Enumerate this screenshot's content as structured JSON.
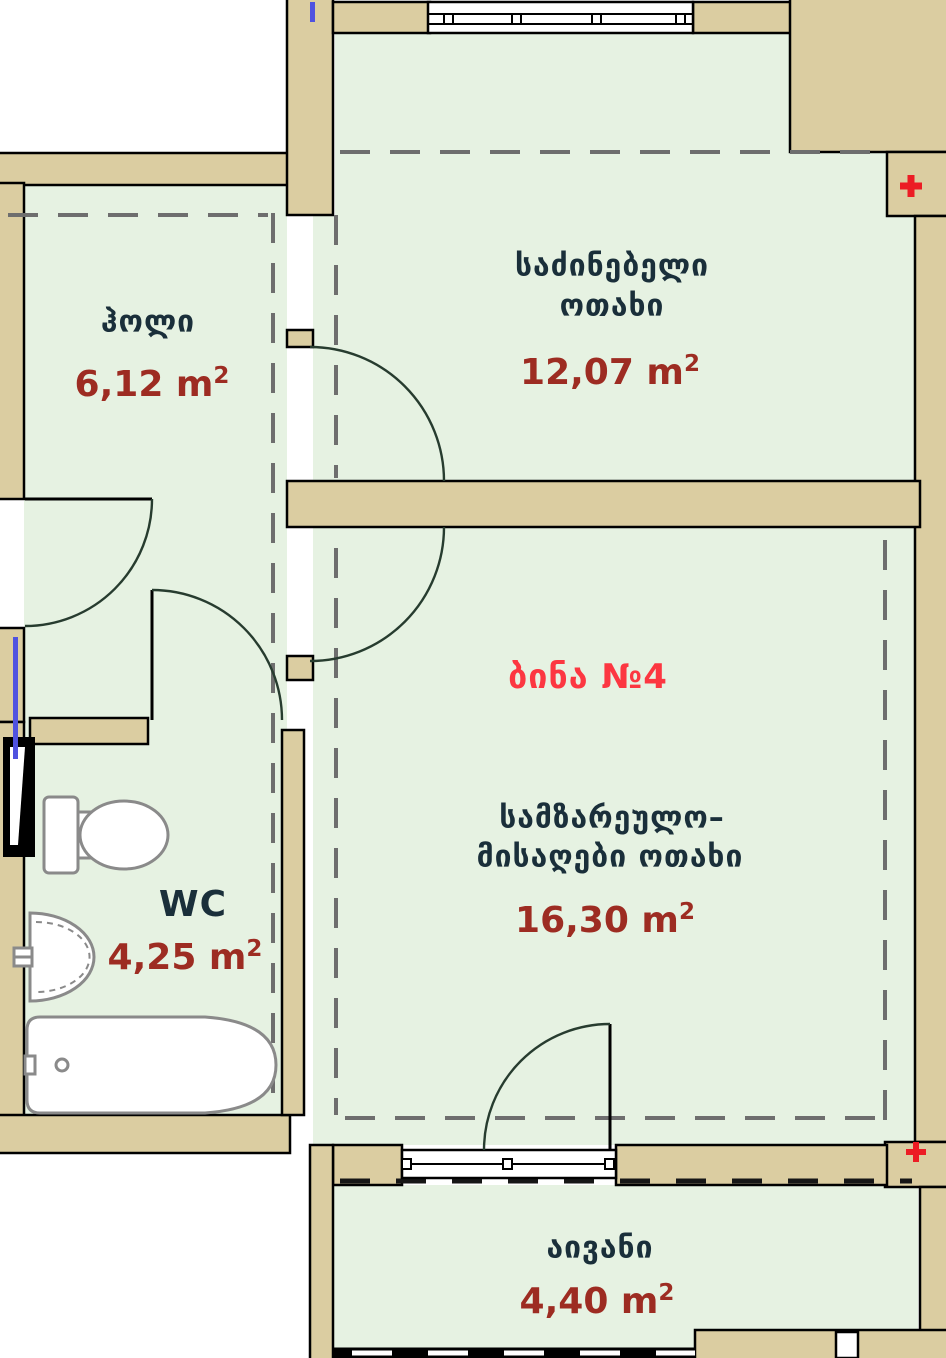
{
  "apartment_label": "ბინა №4",
  "sup": "2",
  "rooms": {
    "hall": {
      "name": "ჰოლი",
      "area": "6,12 m"
    },
    "bedroom": {
      "name_line1": "საძინებელი",
      "name_line2": "ოთახი",
      "area": "12,07 m"
    },
    "kitchen_living": {
      "name_line1": "სამზარეულო–",
      "name_line2": "მისაღები ოთახი",
      "area": "16,30 m"
    },
    "wc": {
      "name": "WC",
      "area": "4,25 m"
    },
    "balcony": {
      "name": "აივანი",
      "area": "4,40 m"
    }
  },
  "colors": {
    "wall_fill": "#dbcda1",
    "floor_fill": "#e6f2e2",
    "wall_outline": "#000000",
    "dashed_line": "#6e6e6e",
    "door_arc": "#273c2f",
    "fixture_outline": "#8a8a8a",
    "room_label": "#1a2f3a",
    "area_label": "#9d2c22",
    "apartment_label": "#fc3741",
    "plus_marker": "#ec1c24",
    "riser_marker": "#4f52e0"
  }
}
